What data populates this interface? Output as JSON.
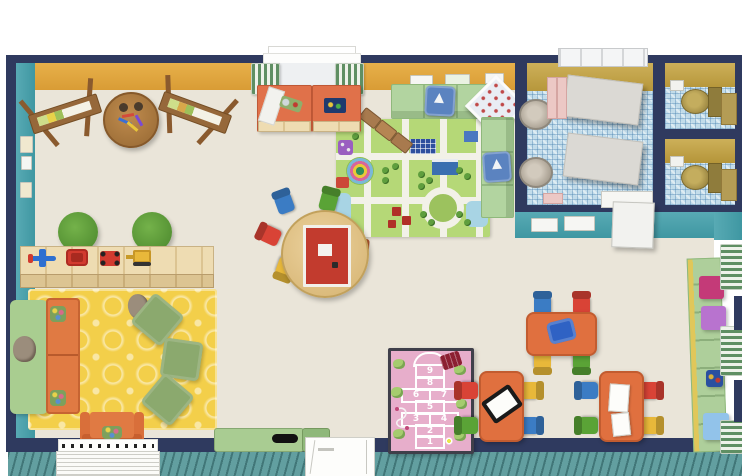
{
  "hopscotch": {
    "cells": [
      "9",
      "8",
      "6",
      "7",
      "5",
      "3",
      "4",
      "2",
      "1"
    ]
  },
  "palette": {
    "outer_wall_navy": "#2f3a5f",
    "wall_yellow": "#dfa63e",
    "wall_teal": "#4aa3ad",
    "classroom_floor": "#eae5d9",
    "bathroom_wall_olive": "#c7a64b",
    "bathroom_floor_mosaic_blue": "#c2dcea",
    "deck_teal": "#629fa0",
    "bench_green": "#b2d4a0",
    "kids_table_orange": "#e0703f",
    "rug_yellow": "#f3cf4a",
    "road_rug_green": "#b5d877",
    "hopscotch_rug_pink": "#e7aecb",
    "chair_blue": "#3b7cc4",
    "chair_green": "#5aa336",
    "chair_red": "#d94336",
    "chair_yellow": "#e8b83a",
    "chair_orange": "#e2703a"
  },
  "items": {
    "rooms": [
      "classroom",
      "washroom",
      "toilet-stall-1",
      "toilet-stall-2",
      "outdoor-deck"
    ],
    "furniture": [
      "easel",
      "art-table",
      "changing-cabinet",
      "cubby-bench",
      "road-play-rug",
      "toy-train",
      "round-activity-table",
      "kids-chairs",
      "green-poufs",
      "toy-shelf",
      "toy-airplane",
      "toy-car",
      "toy-digger",
      "yellow-play-rug",
      "sofa",
      "armchair",
      "floor-cushions",
      "teddy-bear",
      "storage-bench",
      "hopscotch-rug",
      "kids-table",
      "wall-shelf",
      "storage-boxes",
      "sink",
      "toilet",
      "changing-partition",
      "skylight",
      "window",
      "door"
    ]
  }
}
